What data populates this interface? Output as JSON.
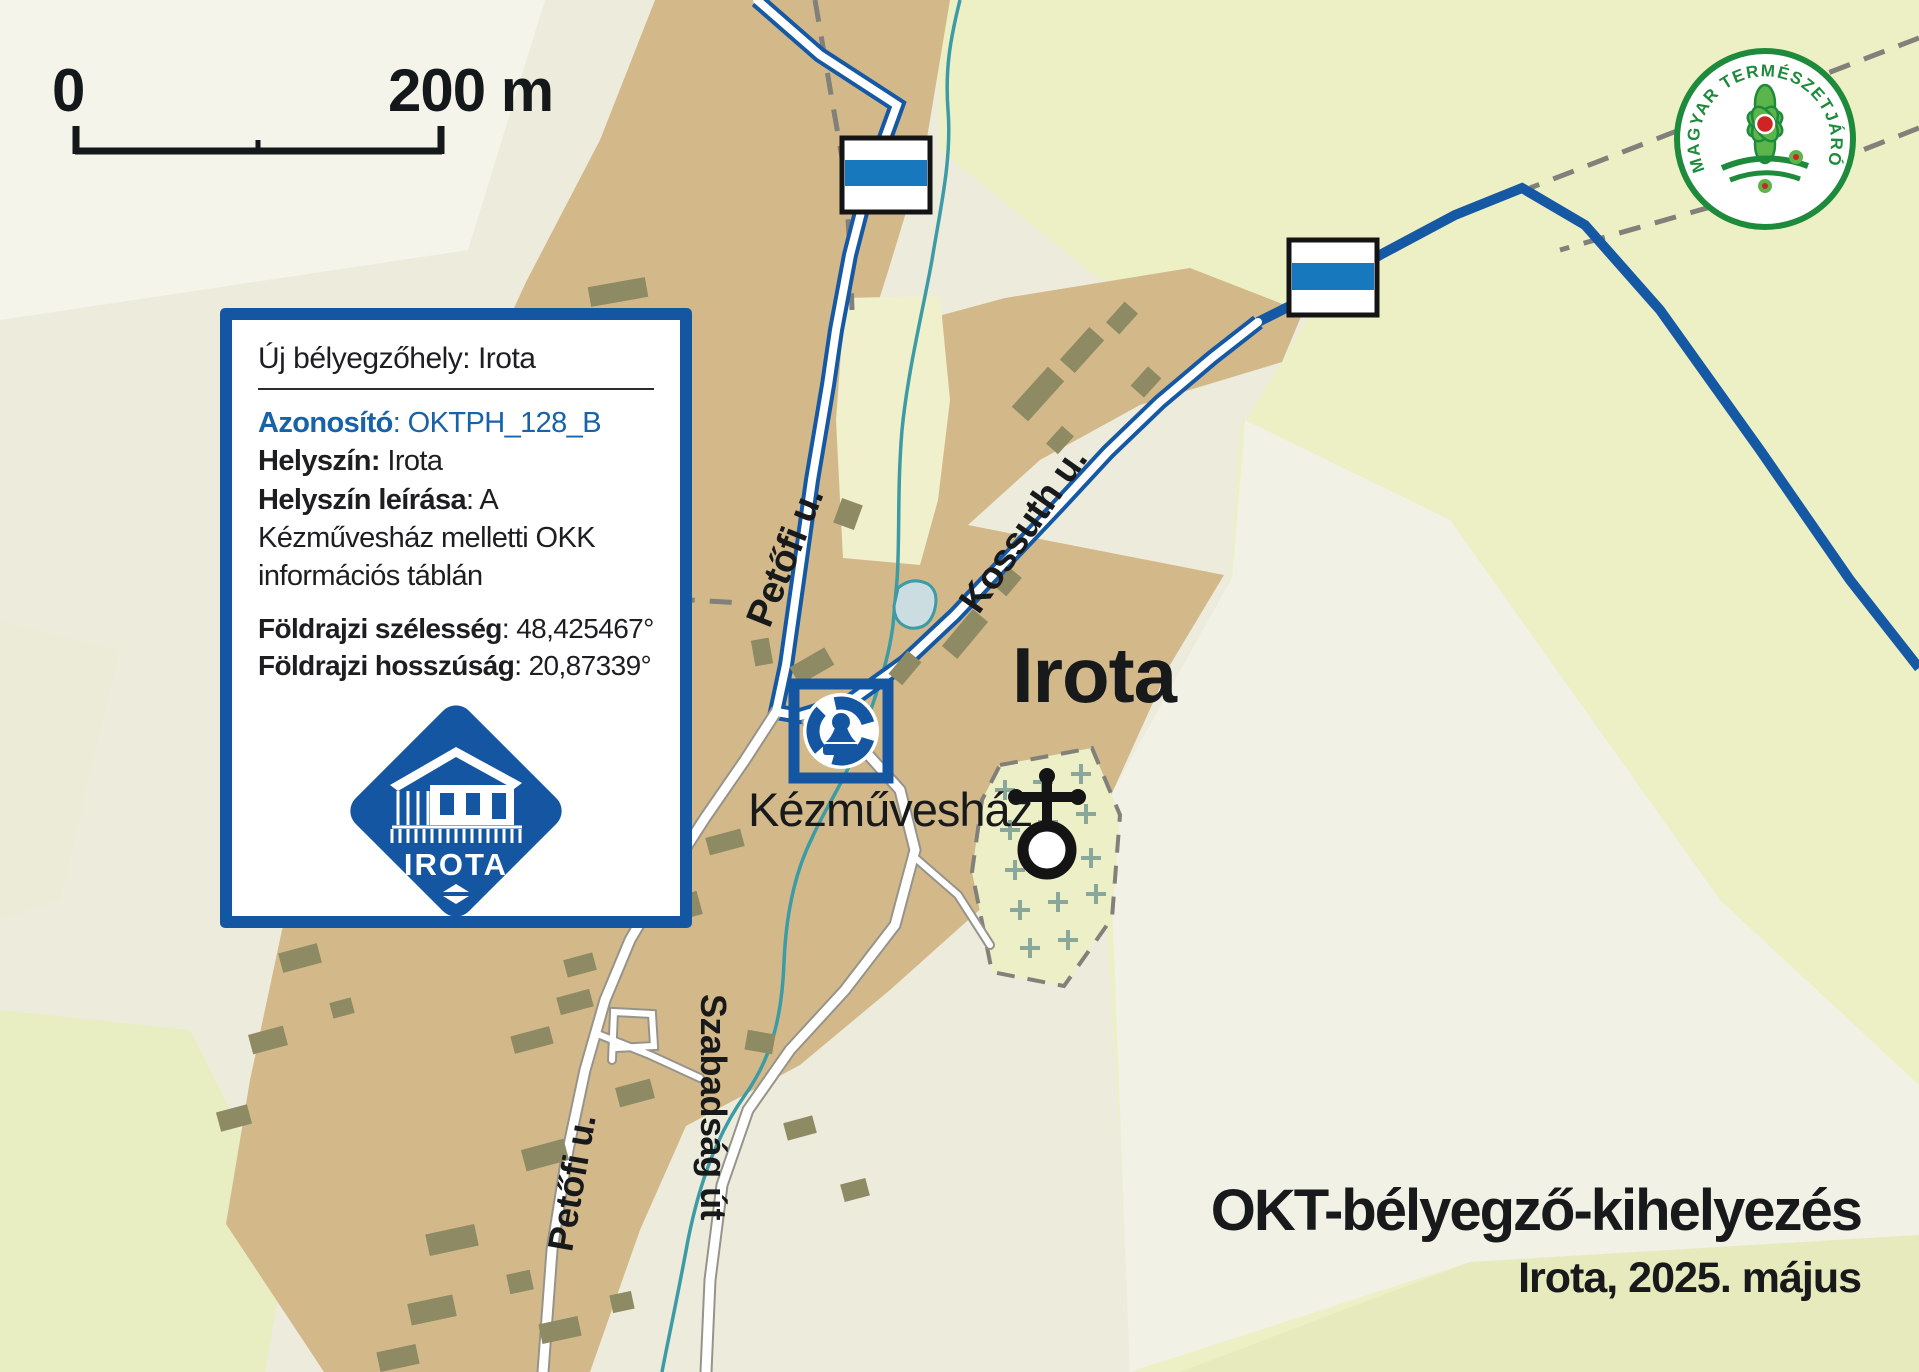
{
  "scalebar": {
    "zero": "0",
    "label": "200 m"
  },
  "logo": {
    "ring_text": "MAGYAR TERMÉSZETJÁRÓ SZÖVETSÉG"
  },
  "info_box": {
    "title": "Új bélyegzőhely: Irota",
    "id_label": "Azonosító",
    "id_value": "OKTPH_128_B",
    "location_label": "Helyszín:",
    "location_value": "Irota",
    "desc_label": "Helyszín leírása",
    "desc_value": "A Kézművesház melletti OKK információs táblán",
    "lat_label": "Földrajzi szélesség",
    "lat_value": "48,425467°",
    "lon_label": "Földrajzi hosszúság",
    "lon_value": "20,87339°",
    "stamp_text": "IROTA"
  },
  "map": {
    "town_label": "Irota",
    "poi_label": "Kézművesház",
    "streets": [
      {
        "label": "Petőfi u."
      },
      {
        "label": "Kossuth u."
      },
      {
        "label": "Szabadság út"
      },
      {
        "label": "Petőfi u."
      }
    ]
  },
  "footer": {
    "title": "OKT-bélyegző-kihelyezés",
    "subtitle": "Irota, 2025. május"
  },
  "colors": {
    "trail_blue": "#1558a4",
    "marker_blue": "#1878be",
    "box_border_blue": "#1456a2",
    "village_tan": "#d3b98a",
    "building_olive": "#8e8a63",
    "field_green": "#edefc5",
    "pale_ground": "#f2f1e6",
    "stream_teal": "#3c9ba5",
    "logo_green": "#1e8a3c"
  }
}
